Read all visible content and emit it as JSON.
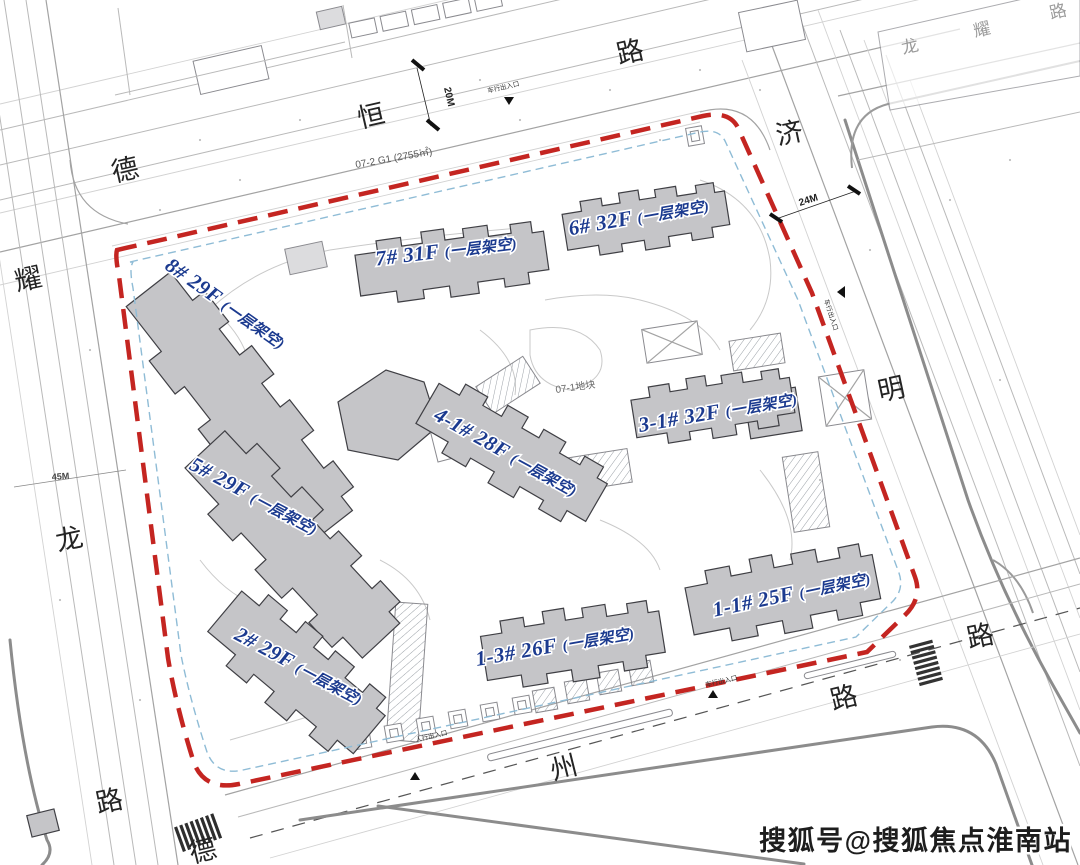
{
  "watermark": {
    "text": "搜狐号@搜狐焦点淮南站"
  },
  "roads": {
    "top": {
      "name": "德恒路",
      "chars": [
        "德",
        "恒",
        "路"
      ]
    },
    "right": {
      "name": "济明路",
      "chars": [
        "济",
        "明",
        "路"
      ]
    },
    "left": {
      "name": "耀龙路",
      "chars": [
        "耀",
        "龙",
        "路"
      ]
    },
    "bottom": {
      "name": "德州路",
      "chars": [
        "德",
        "州",
        "路"
      ]
    },
    "top_right": {
      "name": "龙耀路",
      "chars": [
        "龙",
        "耀",
        "路"
      ]
    }
  },
  "parcels": {
    "adjacent": "07-2 G1 (2755㎡)",
    "site": "07-1地块"
  },
  "dimensions": {
    "top_road_width": "20M",
    "right_road_width": "24M",
    "left_road_width": "45M"
  },
  "entrances": {
    "top": "车行出入口",
    "right": "车行出入口",
    "bottom": "车行出入口",
    "bottom_left": "人行出入口"
  },
  "buildings": [
    {
      "id": "8#",
      "floors": "29F",
      "label": "8# 29F",
      "note": "(一层架空)"
    },
    {
      "id": "7#",
      "floors": "31F",
      "label": "7# 31F",
      "note": "(一层架空)"
    },
    {
      "id": "6#",
      "floors": "32F",
      "label": "6# 32F",
      "note": "(一层架空)"
    },
    {
      "id": "4-1#",
      "floors": "28F",
      "label": "4-1# 28F",
      "note": "(一层架空)"
    },
    {
      "id": "3-1#",
      "floors": "32F",
      "label": "3-1# 32F",
      "note": "(一层架空)"
    },
    {
      "id": "5#",
      "floors": "29F",
      "label": "5# 29F",
      "note": "(一层架空)"
    },
    {
      "id": "2#",
      "floors": "29F",
      "label": "2# 29F",
      "note": "(一层架空)"
    },
    {
      "id": "1-3#",
      "floors": "26F",
      "label": "1-3# 26F",
      "note": "(一层架空)"
    },
    {
      "id": "1-1#",
      "floors": "25F",
      "label": "1-1# 25F",
      "note": "(一层架空)"
    }
  ],
  "colors": {
    "boundary_red": "#c42521",
    "label_blue": "#1b3a8f",
    "building_gray": "#c5c5c8",
    "setback_blue": "#8fbcd6"
  }
}
